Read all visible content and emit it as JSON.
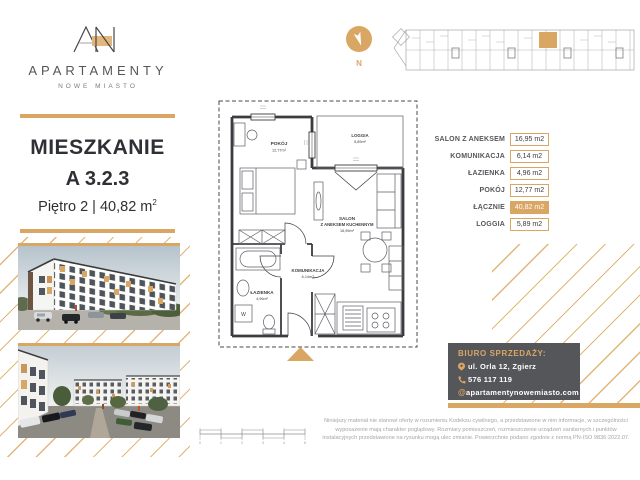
{
  "brand": {
    "name": "APARTAMENTY",
    "tagline": "NOWE MIASTO"
  },
  "unit": {
    "heading": "MIESZKANIE",
    "number": "A 3.2.3",
    "floor": "Piętro 2",
    "separator": "|",
    "area": "40,82 m",
    "area_exponent": "2"
  },
  "compass": {
    "north_label": "N"
  },
  "floor_plan": {
    "rooms": [
      {
        "name": "POKÓJ",
        "area": "12,77m²"
      },
      {
        "name": "LOGGIA",
        "area": "5,89m²"
      },
      {
        "name": "SALON",
        "name_line2": "Z ANEKSEM KUCHENNYM",
        "area": "16,95m²"
      },
      {
        "name": "KOMUNIKACJA",
        "area": "6,14m2"
      },
      {
        "name": "ŁAZIENKA",
        "area": "4,96m²"
      }
    ],
    "washer_label": "W"
  },
  "area_table": {
    "rows": [
      {
        "label": "SALON Z ANEKSEM",
        "value": "16,95 m2",
        "highlight": false
      },
      {
        "label": "KOMUNIKACJA",
        "value": "6,14 m2",
        "highlight": false
      },
      {
        "label": "ŁAZIENKA",
        "value": "4,96 m2",
        "highlight": false
      },
      {
        "label": "POKÓJ",
        "value": "12,77 m2",
        "highlight": false
      },
      {
        "label": "ŁĄCZNIE",
        "value": "40,82 m2",
        "highlight": true
      },
      {
        "label": "LOGGIA",
        "value": "5,89 m2",
        "highlight": false
      }
    ]
  },
  "sales_office": {
    "title": "BIURO SPRZEDAŻY:",
    "address": "ul. Orla 12, Zgierz",
    "phone": "576 117 119",
    "website": "apartamentynowemiasto.com"
  },
  "disclaimer": {
    "line1": "Niniejszy materiał nie stanowi oferty w rozumieniu Kodeksu cywilnego, a przedstawione w nim informacje, w szczególności",
    "line2": "wyposażenie mają charakter poglądowy. Rozmiary pomieszczeń, rozmieszczenie urządzeń sanitarnych i punktów",
    "line3": "instalacyjnych przedstawione na rysunku mogą ulec zmianie. Powierzchnie podano zgodnie z normą PN-ISO 9836:2022.07."
  },
  "scale_bar": {
    "ticks": [
      "0",
      "1",
      "2",
      "3",
      "4",
      "5"
    ]
  },
  "colors": {
    "gold": "#D9A664",
    "gold_light": "#E2B77E",
    "dark_gray": "#55565A",
    "text_dark": "#2F3035"
  }
}
